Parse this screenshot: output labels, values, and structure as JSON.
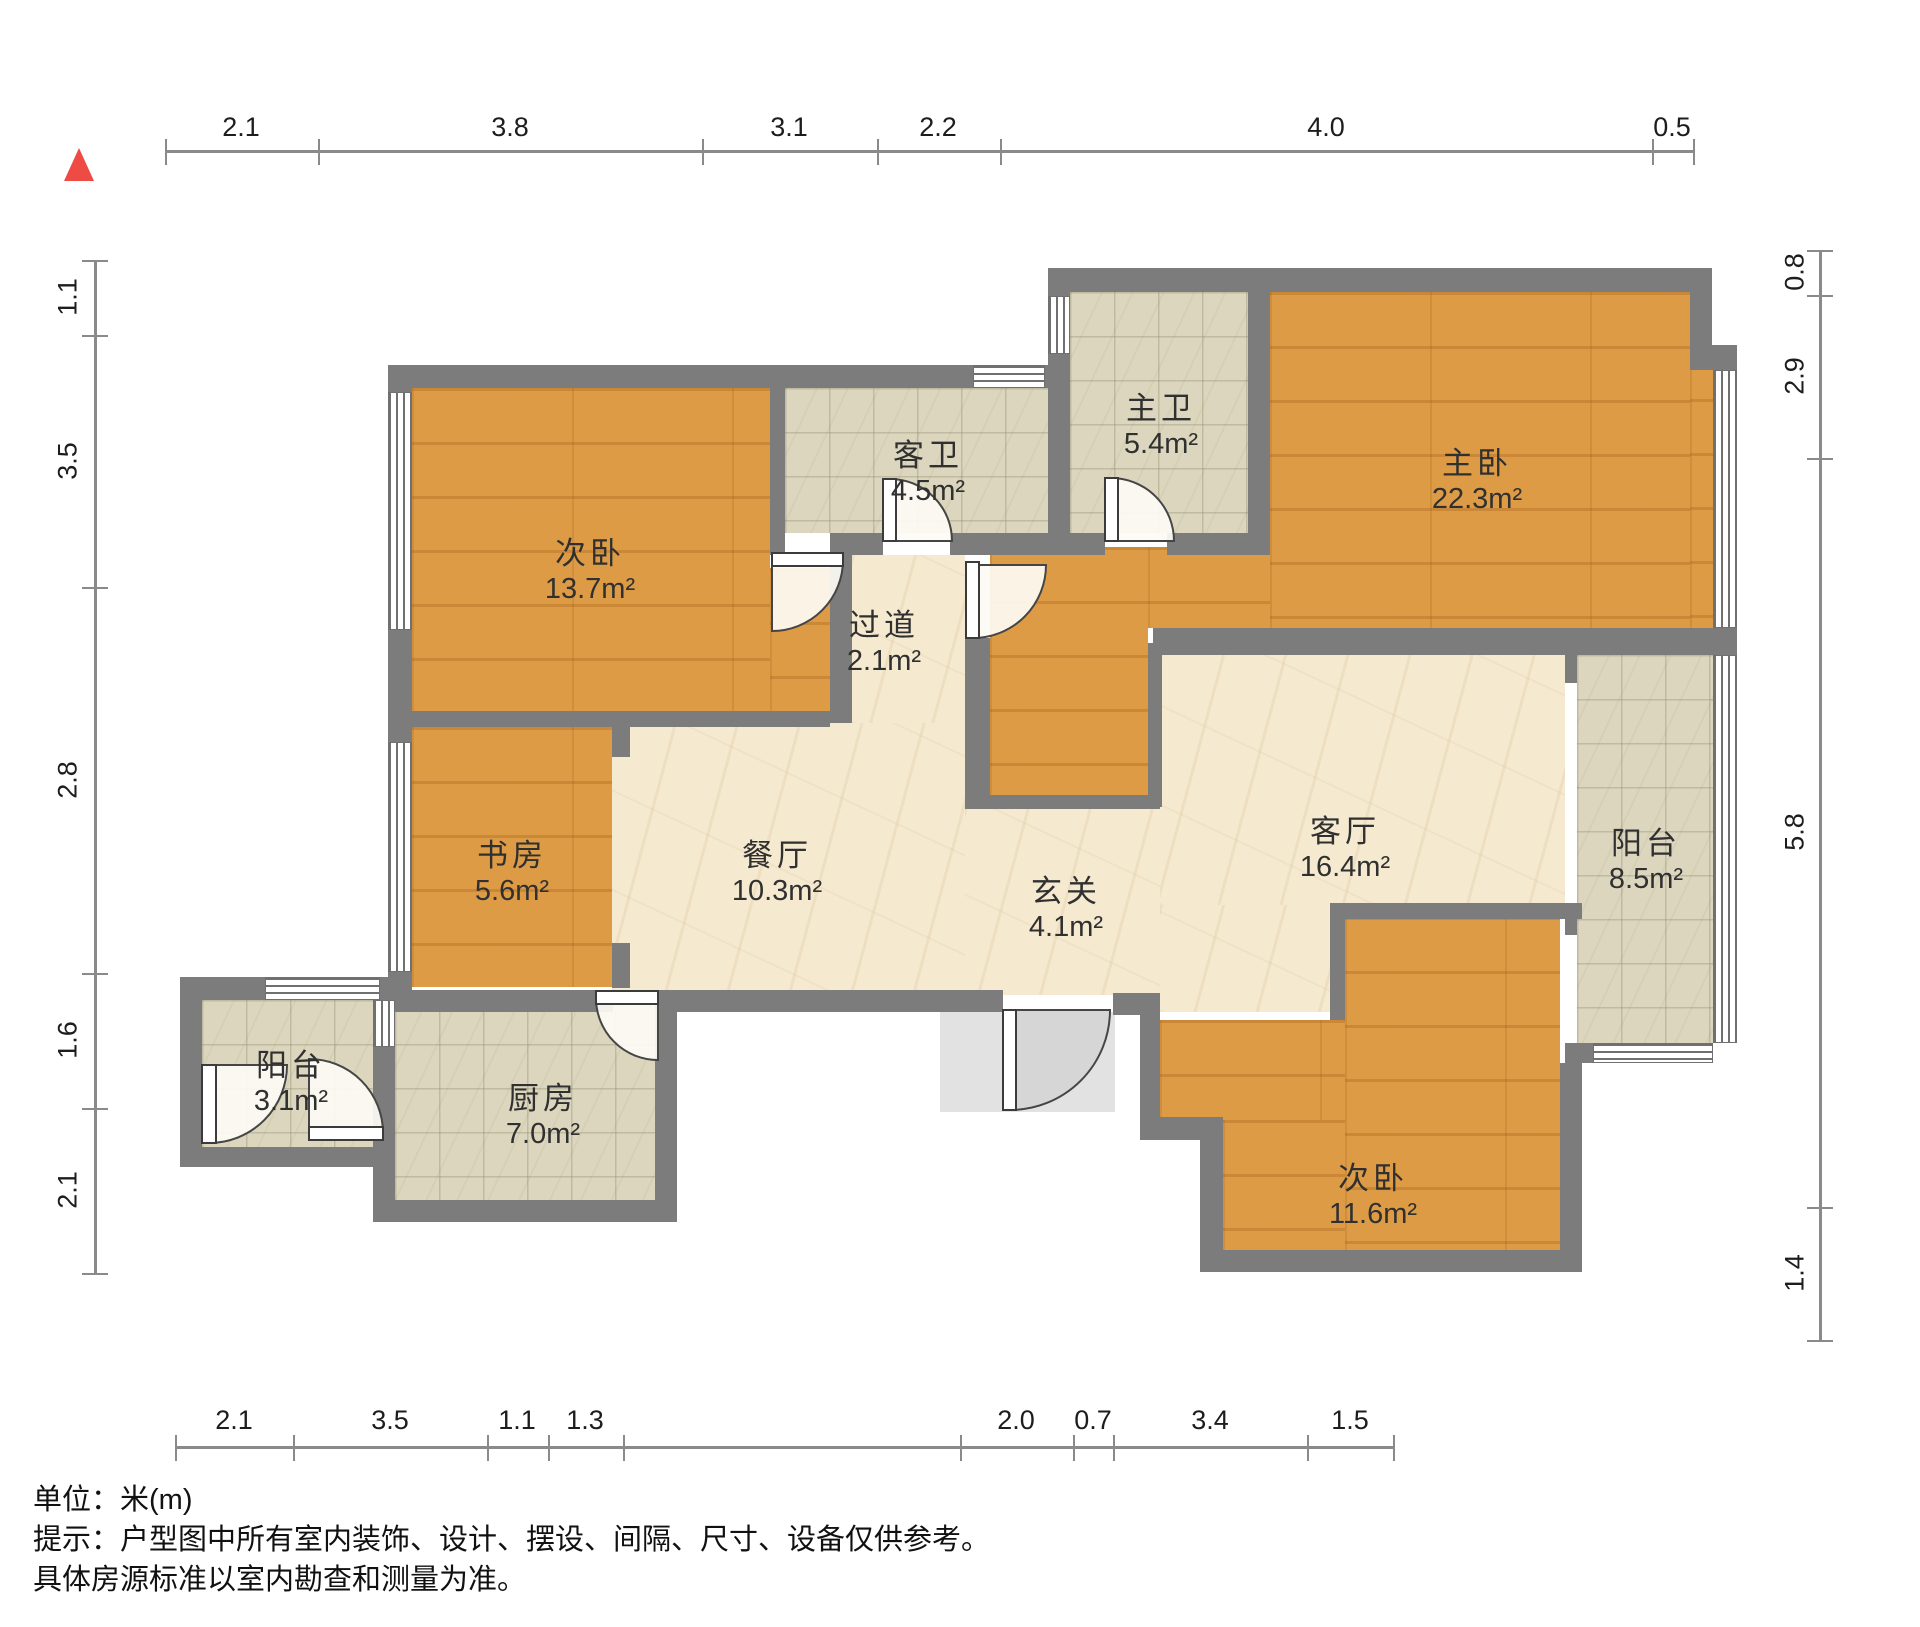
{
  "compass": {
    "icon": "north-triangle",
    "color": "#ee4b45"
  },
  "rooms": [
    {
      "name": "次卧",
      "area": "13.7m²"
    },
    {
      "name": "客卫",
      "area": "4.5m²"
    },
    {
      "name": "主卫",
      "area": "5.4m²"
    },
    {
      "name": "主卧",
      "area": "22.3m²"
    },
    {
      "name": "过道",
      "area": "2.1m²"
    },
    {
      "name": "书房",
      "area": "5.6m²"
    },
    {
      "name": "餐厅",
      "area": "10.3m²"
    },
    {
      "name": "玄关",
      "area": "4.1m²"
    },
    {
      "name": "客厅",
      "area": "16.4m²"
    },
    {
      "name": "阳台",
      "area": "8.5m²"
    },
    {
      "name": "阳台",
      "area": "3.1m²"
    },
    {
      "name": "厨房",
      "area": "7.0m²"
    },
    {
      "name": "次卧",
      "area": "11.6m²"
    }
  ],
  "dimensions": {
    "top": [
      "2.1",
      "3.8",
      "3.1",
      "2.2",
      "4.0",
      "0.5"
    ],
    "left": [
      "1.1",
      "3.5",
      "2.8",
      "1.6",
      "2.1"
    ],
    "right": [
      "0.8",
      "2.9",
      "5.8",
      "1.4"
    ],
    "bottom": [
      "2.1",
      "3.5",
      "1.1",
      "1.3",
      "2.0",
      "0.7",
      "3.4",
      "1.5"
    ]
  },
  "footer": {
    "unit": "单位：米(m)",
    "tip1": "提示：户型图中所有室内装饰、设计、摆设、间隔、尺寸、设备仅供参考。",
    "tip2": "具体房源标准以室内勘查和测量为准。"
  },
  "colors": {
    "wall": "#7c7c7c",
    "wood": "#de9b45",
    "marble": "#f5e9d0",
    "tile": "#dbd6bd",
    "compass": "#ee4b45"
  }
}
